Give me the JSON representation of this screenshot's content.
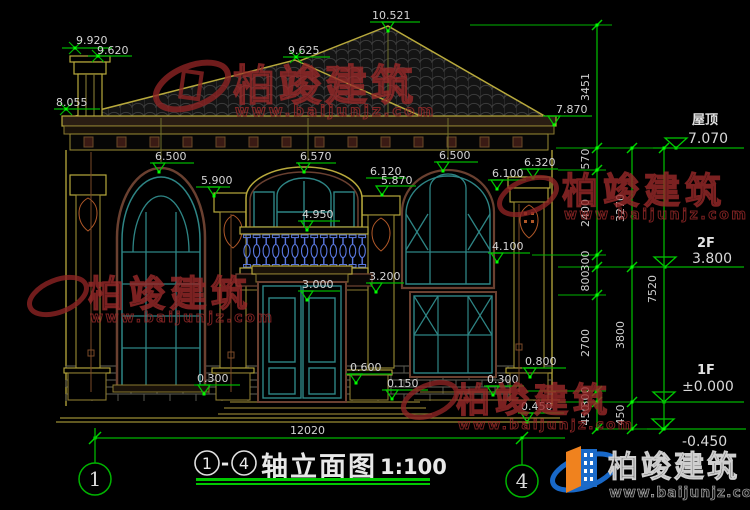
{
  "titleblock": {
    "name": "轴立面图",
    "scale": "1:100",
    "separator": "-"
  },
  "axes": {
    "left": "1",
    "right": "4"
  },
  "hdim": {
    "total": "12020"
  },
  "levels": {
    "roof_label": "屋顶",
    "roof_value": "7.070",
    "f2_label": "2F",
    "f2_value": "3.800",
    "f1_label": "1F",
    "f1_value": "±0.000",
    "below_value": "-0.450"
  },
  "elev": {
    "chimney_top": "9.920",
    "chimney_cap": "9.620",
    "ridge_main": "10.521",
    "ridge_left": "9.625",
    "eave_left": "8.055",
    "eave_right": "7.870",
    "lwin_top": "6.500",
    "p2_top": "5.900",
    "cwin_top": "6.570",
    "p3_top": "6.120",
    "p3_cap": "5.870",
    "rwin_top": "6.500",
    "p4_cap": "6.100",
    "p4_top": "6.320",
    "balcony_rail": "4.950",
    "rwin_sill": "4.100",
    "door_top": "3.000",
    "balcony_slab": "3.200",
    "porch": "0.600",
    "step": "0.150",
    "lwin_sill": "0.300",
    "rporch": "0.800",
    "rstep": "0.300",
    "rbase": "0.450"
  },
  "vdims": {
    "c1": [
      "3451",
      "570",
      "2400",
      "300",
      "800",
      "2700",
      "300",
      "450"
    ],
    "c2": [
      "3270",
      "3800",
      "450"
    ],
    "c3": [
      "7520"
    ]
  },
  "watermark": {
    "brand": "柏竣建筑",
    "url": "www.baijunjz.com"
  },
  "colors": {
    "cad_green": "#00b400",
    "grip_green": "#00ff00",
    "line_yellow": "#b8a93c",
    "trim_brown": "#6a4030",
    "frame_teal": "#2e8585",
    "baluster_blue": "#5a78e0",
    "wm_red": "#9a2a2a",
    "logo_blue": "#1868c8",
    "logo_orange": "#f0821e"
  }
}
